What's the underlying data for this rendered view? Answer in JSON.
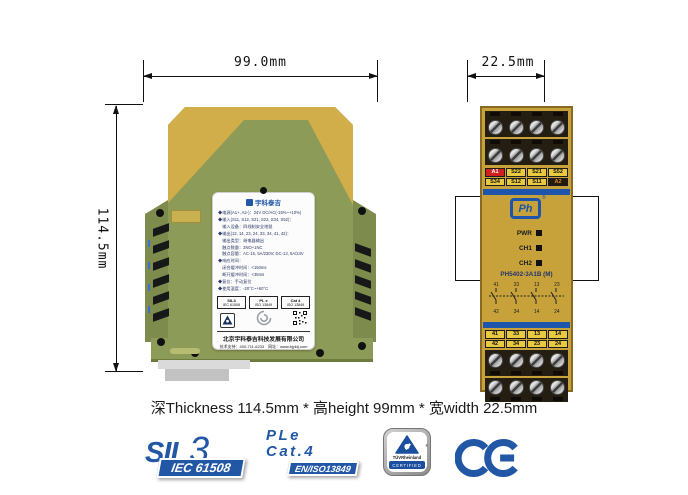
{
  "front_view": {
    "width_label": "99.0mm",
    "height_label": "114.5mm",
    "label": {
      "brand": "宇科泰吉",
      "lines": [
        "◆电源(A1+, A2-)：24V DC/AC(-15%~+10%)",
        "◆输入(S11, S12, S21, S22, S34, S52)：",
        "　输入设备：四线制安全地毯",
        "◆输出(13, 14, 23, 24, 33, 34, 41, 42)：",
        "　输出类型：继电器输出",
        "　触点数量：3NO+1NC",
        "　触点容量：AC-15, 5A/230V; DC-13, 5A/24V",
        "◆响应时间：",
        "　闭合缓冲时间：<150ms",
        "　断开缓冲时间：<35ms",
        "◆复位：手动复位",
        "◆使用温度：-20°C~+60°C"
      ],
      "cert_boxes": [
        {
          "line1": "SIL3",
          "line2": "IEC 61508"
        },
        {
          "line1": "PL e",
          "line2": "ISO 13849"
        },
        {
          "line1": "Cat 4",
          "line2": "ISO 13849"
        }
      ],
      "company": "北京宇科泰吉科技发展有限公司",
      "contact": "技术支持：400-711-6233　网址：www.bjyktj.com"
    }
  },
  "side_view": {
    "width_label": "22.5mm",
    "top_terminals": {
      "row1": [
        "A1",
        "S22",
        "S21",
        "S52"
      ],
      "row2": [
        "S34",
        "S12",
        "S11",
        "A2"
      ]
    },
    "logo": "Ph",
    "logo_reg": "®",
    "leds": [
      "PWR",
      "CH1",
      "CH2"
    ],
    "model": "PH5402-3A1B (M)",
    "contacts": {
      "top": [
        "41",
        "33",
        "13",
        "23"
      ],
      "bottom": [
        "42",
        "34",
        "14",
        "24"
      ]
    },
    "bottom_terminals": {
      "row1": [
        "41",
        "33",
        "13",
        "14"
      ],
      "row2": [
        "42",
        "34",
        "23",
        "24"
      ]
    }
  },
  "summary_text": "深Thickness 114.5mm * 高height 99mm * 宽width 22.5mm",
  "certs": {
    "sil": {
      "prefix": "SIL",
      "level": "3",
      "standard": "IEC 61508"
    },
    "pl": {
      "line1": "PLe",
      "line2": "Cat.4",
      "standard": "EN/ISO13849"
    },
    "tuv": {
      "name": "TÜVRheinland",
      "reg": "®",
      "badge": "CERTIFIED"
    },
    "ce_label": "CE"
  },
  "colors": {
    "accent_blue": "#2257a6",
    "bar_blue": "#1d55ad",
    "device_olive": "#8d9b58",
    "device_yellow": "#d2ae4a",
    "panel_gold": "#c7a23a",
    "terminal_red": "#cf2020",
    "terminal_yellow": "#e8c93f"
  }
}
